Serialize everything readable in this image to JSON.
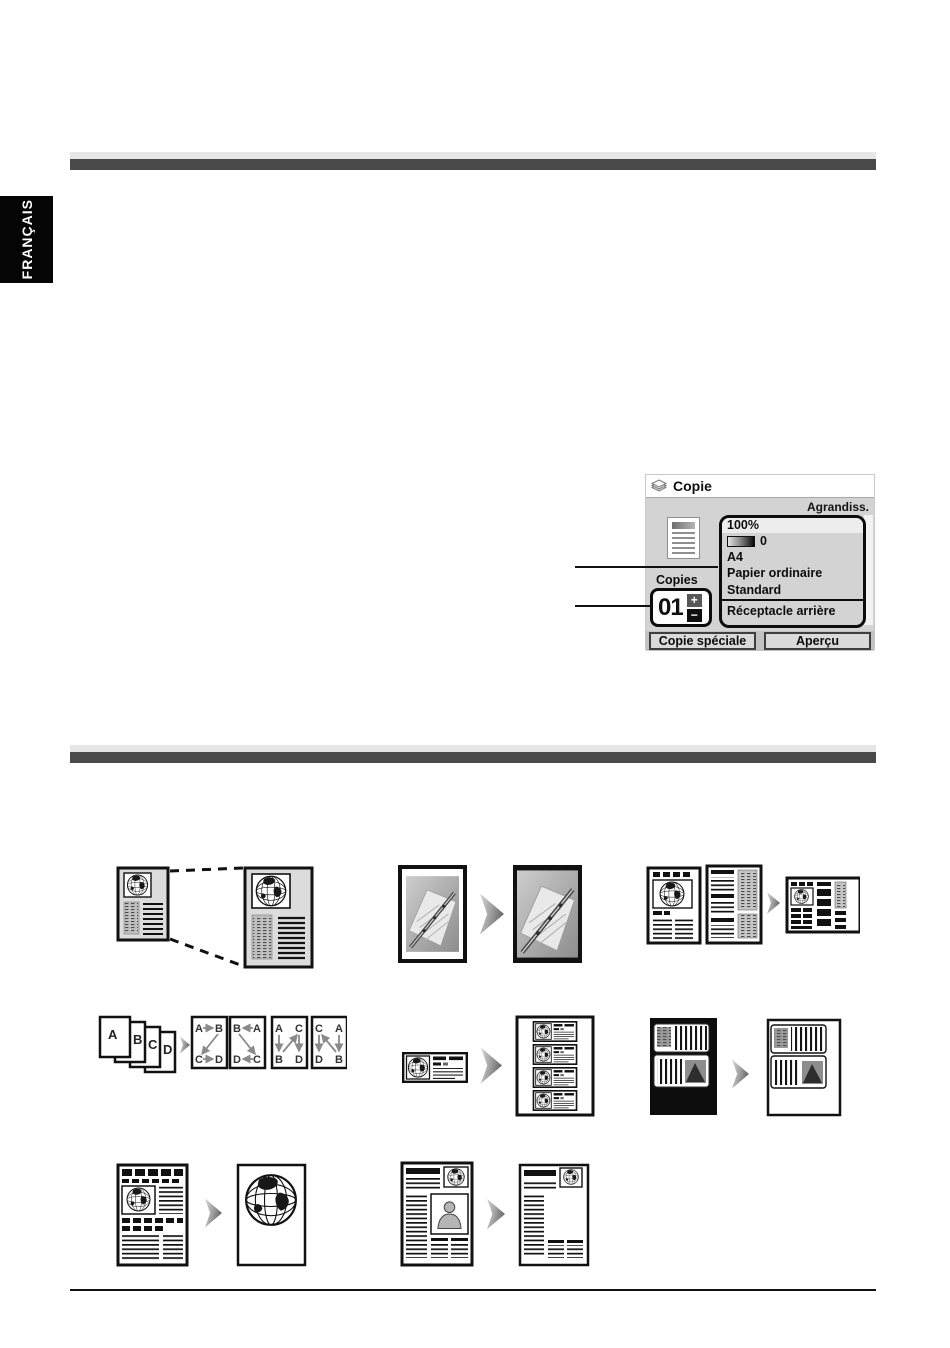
{
  "page": {
    "language_tab": "FRANÇAIS"
  },
  "lcd": {
    "title": "Copie",
    "header_right": "Agrandiss.",
    "settings": {
      "zoom": "100%",
      "intensity_value": "0",
      "paper_size": "A4",
      "paper_type": "Papier ordinaire",
      "quality": "Standard",
      "tray": "Réceptacle arrière"
    },
    "copies_label": "Copies",
    "copies_value": "01",
    "stepper": {
      "plus": "+",
      "minus": "−"
    },
    "buttons": {
      "special": "Copie spéciale",
      "preview": "Aperçu"
    }
  },
  "illustrations": {
    "enlarge_reduce": {
      "name": "enlarge-reduce-copy"
    },
    "borderless": {
      "name": "borderless-photo-copy"
    },
    "two_on_one": {
      "name": "two-on-one-copy"
    },
    "four_on_one": {
      "name": "four-on-one-copy",
      "source_letters": [
        "A",
        "B",
        "C",
        "D"
      ],
      "layouts": [
        {
          "tl": "A",
          "tr": "B",
          "bl": "C",
          "br": "D"
        },
        {
          "tl": "B",
          "tr": "A",
          "bl": "D",
          "br": "C"
        },
        {
          "tl": "A",
          "tr": "C",
          "bl": "B",
          "br": "D"
        },
        {
          "tl": "C",
          "tr": "A",
          "bl": "D",
          "br": "B"
        }
      ]
    },
    "image_repeat": {
      "name": "image-repeat-copy"
    },
    "frame_erase": {
      "name": "frame-erase-copy"
    },
    "trimming": {
      "name": "trimming-copy"
    },
    "masking": {
      "name": "masking-copy"
    }
  },
  "colors": {
    "bar_dark": "#4a4a4a",
    "bar_light": "#e6e6e6",
    "tab_bg": "#050505",
    "lcd_bg": "#d3d3d3",
    "panel_border": "#0c0c0c"
  }
}
